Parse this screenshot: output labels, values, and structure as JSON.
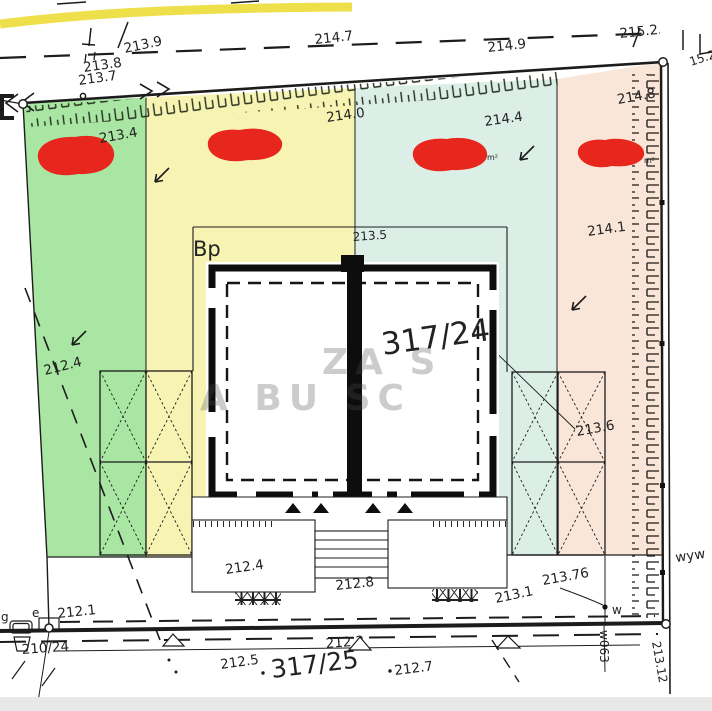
{
  "document": {
    "type": "cadastral-site-plan"
  },
  "colors": {
    "zone_green": "#a9e6a3",
    "zone_yellow": "#f7f3b2",
    "zone_teal": "#dbefe7",
    "zone_pink": "#fae6d9",
    "shrub_red": "#e7271d",
    "road_band_yellow": "#eee04a",
    "line": "#1c1c1c",
    "bottom_strip": "#e8e8e8"
  },
  "parcels": {
    "main": "317/24",
    "south": "317/25",
    "west": "210/24"
  },
  "land_use_code": "Bp",
  "elevations": {
    "road_1": "213.9",
    "road_2": "214.7",
    "road_3": "214.9",
    "road_4": "215.2",
    "road_edge_cut": "15.2",
    "corner_a": "213.8",
    "corner_b": "213.7",
    "zone_green_top": "213.4",
    "zone_yellow_top": "214.0",
    "zone_teal_top": "214.4",
    "zone_pink_top": "214.8",
    "zone_pink_mid": "214.1",
    "bp_line": "213.5",
    "zone_green_mid": "212.4",
    "right_mid": "213.6",
    "terrace_left": "212.4",
    "steps": "212.8",
    "bottom_right": "213.1",
    "bottom_w": "213.76",
    "bottom_left": "212.1",
    "boundary_line": "212.2",
    "south_1": "212.5",
    "south_2": "212.7",
    "right_corner": "213.12"
  },
  "markers": {
    "w": "w",
    "w063": "w063",
    "wyw": "wyw",
    "g": "g",
    "e": "e",
    "m2_teal": "m²",
    "m2_pink": "m²"
  },
  "watermark": {
    "line1": "ZA      S",
    "line2": "A  BU  SC"
  }
}
